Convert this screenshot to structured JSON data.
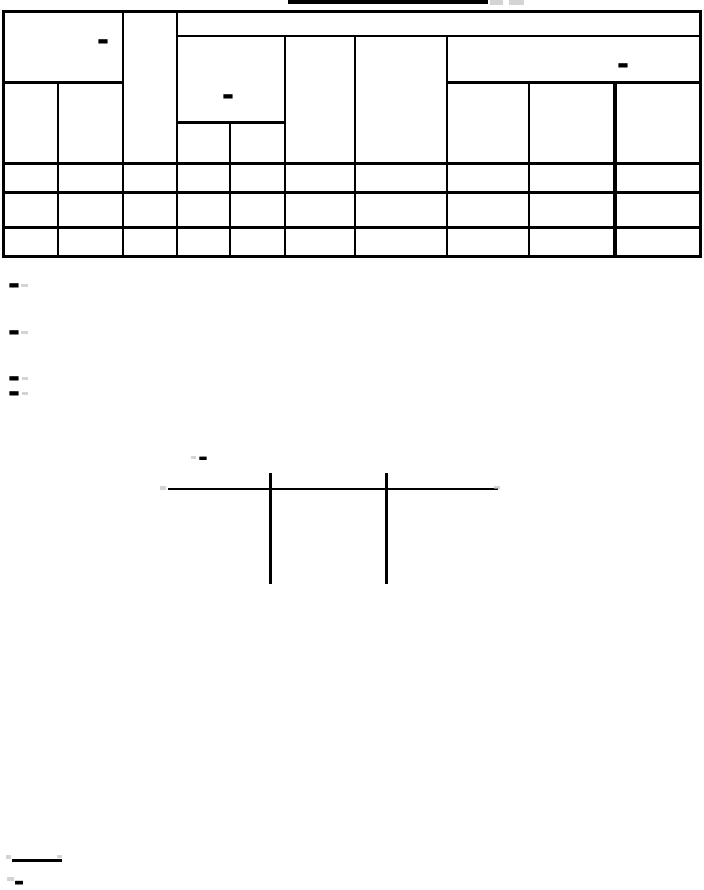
{
  "page": {
    "background": "#ffffff",
    "ink": "#000000",
    "faint_ink": "#bdbdbd"
  },
  "header": {
    "title_text": "",
    "title_underlined": true
  },
  "table": {
    "columns": 10,
    "body_rows": 3,
    "header_marks": {
      "left": "-",
      "middle": "-",
      "right": "-"
    }
  },
  "paragraph_marks": [
    "-",
    "-",
    "-",
    "-"
  ],
  "figure": {
    "label_mark": "-",
    "tick_count": 2
  },
  "footnote": {
    "mark": "-"
  }
}
